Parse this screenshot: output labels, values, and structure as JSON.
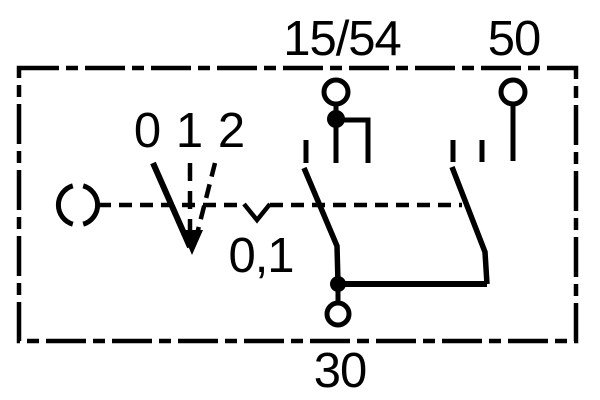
{
  "colors": {
    "ink": "#000000",
    "background": "#ffffff"
  },
  "diagram_type": "ignition-starter-switch-schematic",
  "labels": {
    "terminal_15_54": "15/54",
    "terminal_50": "50",
    "terminal_30": "30",
    "position_0": "0",
    "position_1": "1",
    "position_2": "2",
    "momentary": "0,1"
  }
}
